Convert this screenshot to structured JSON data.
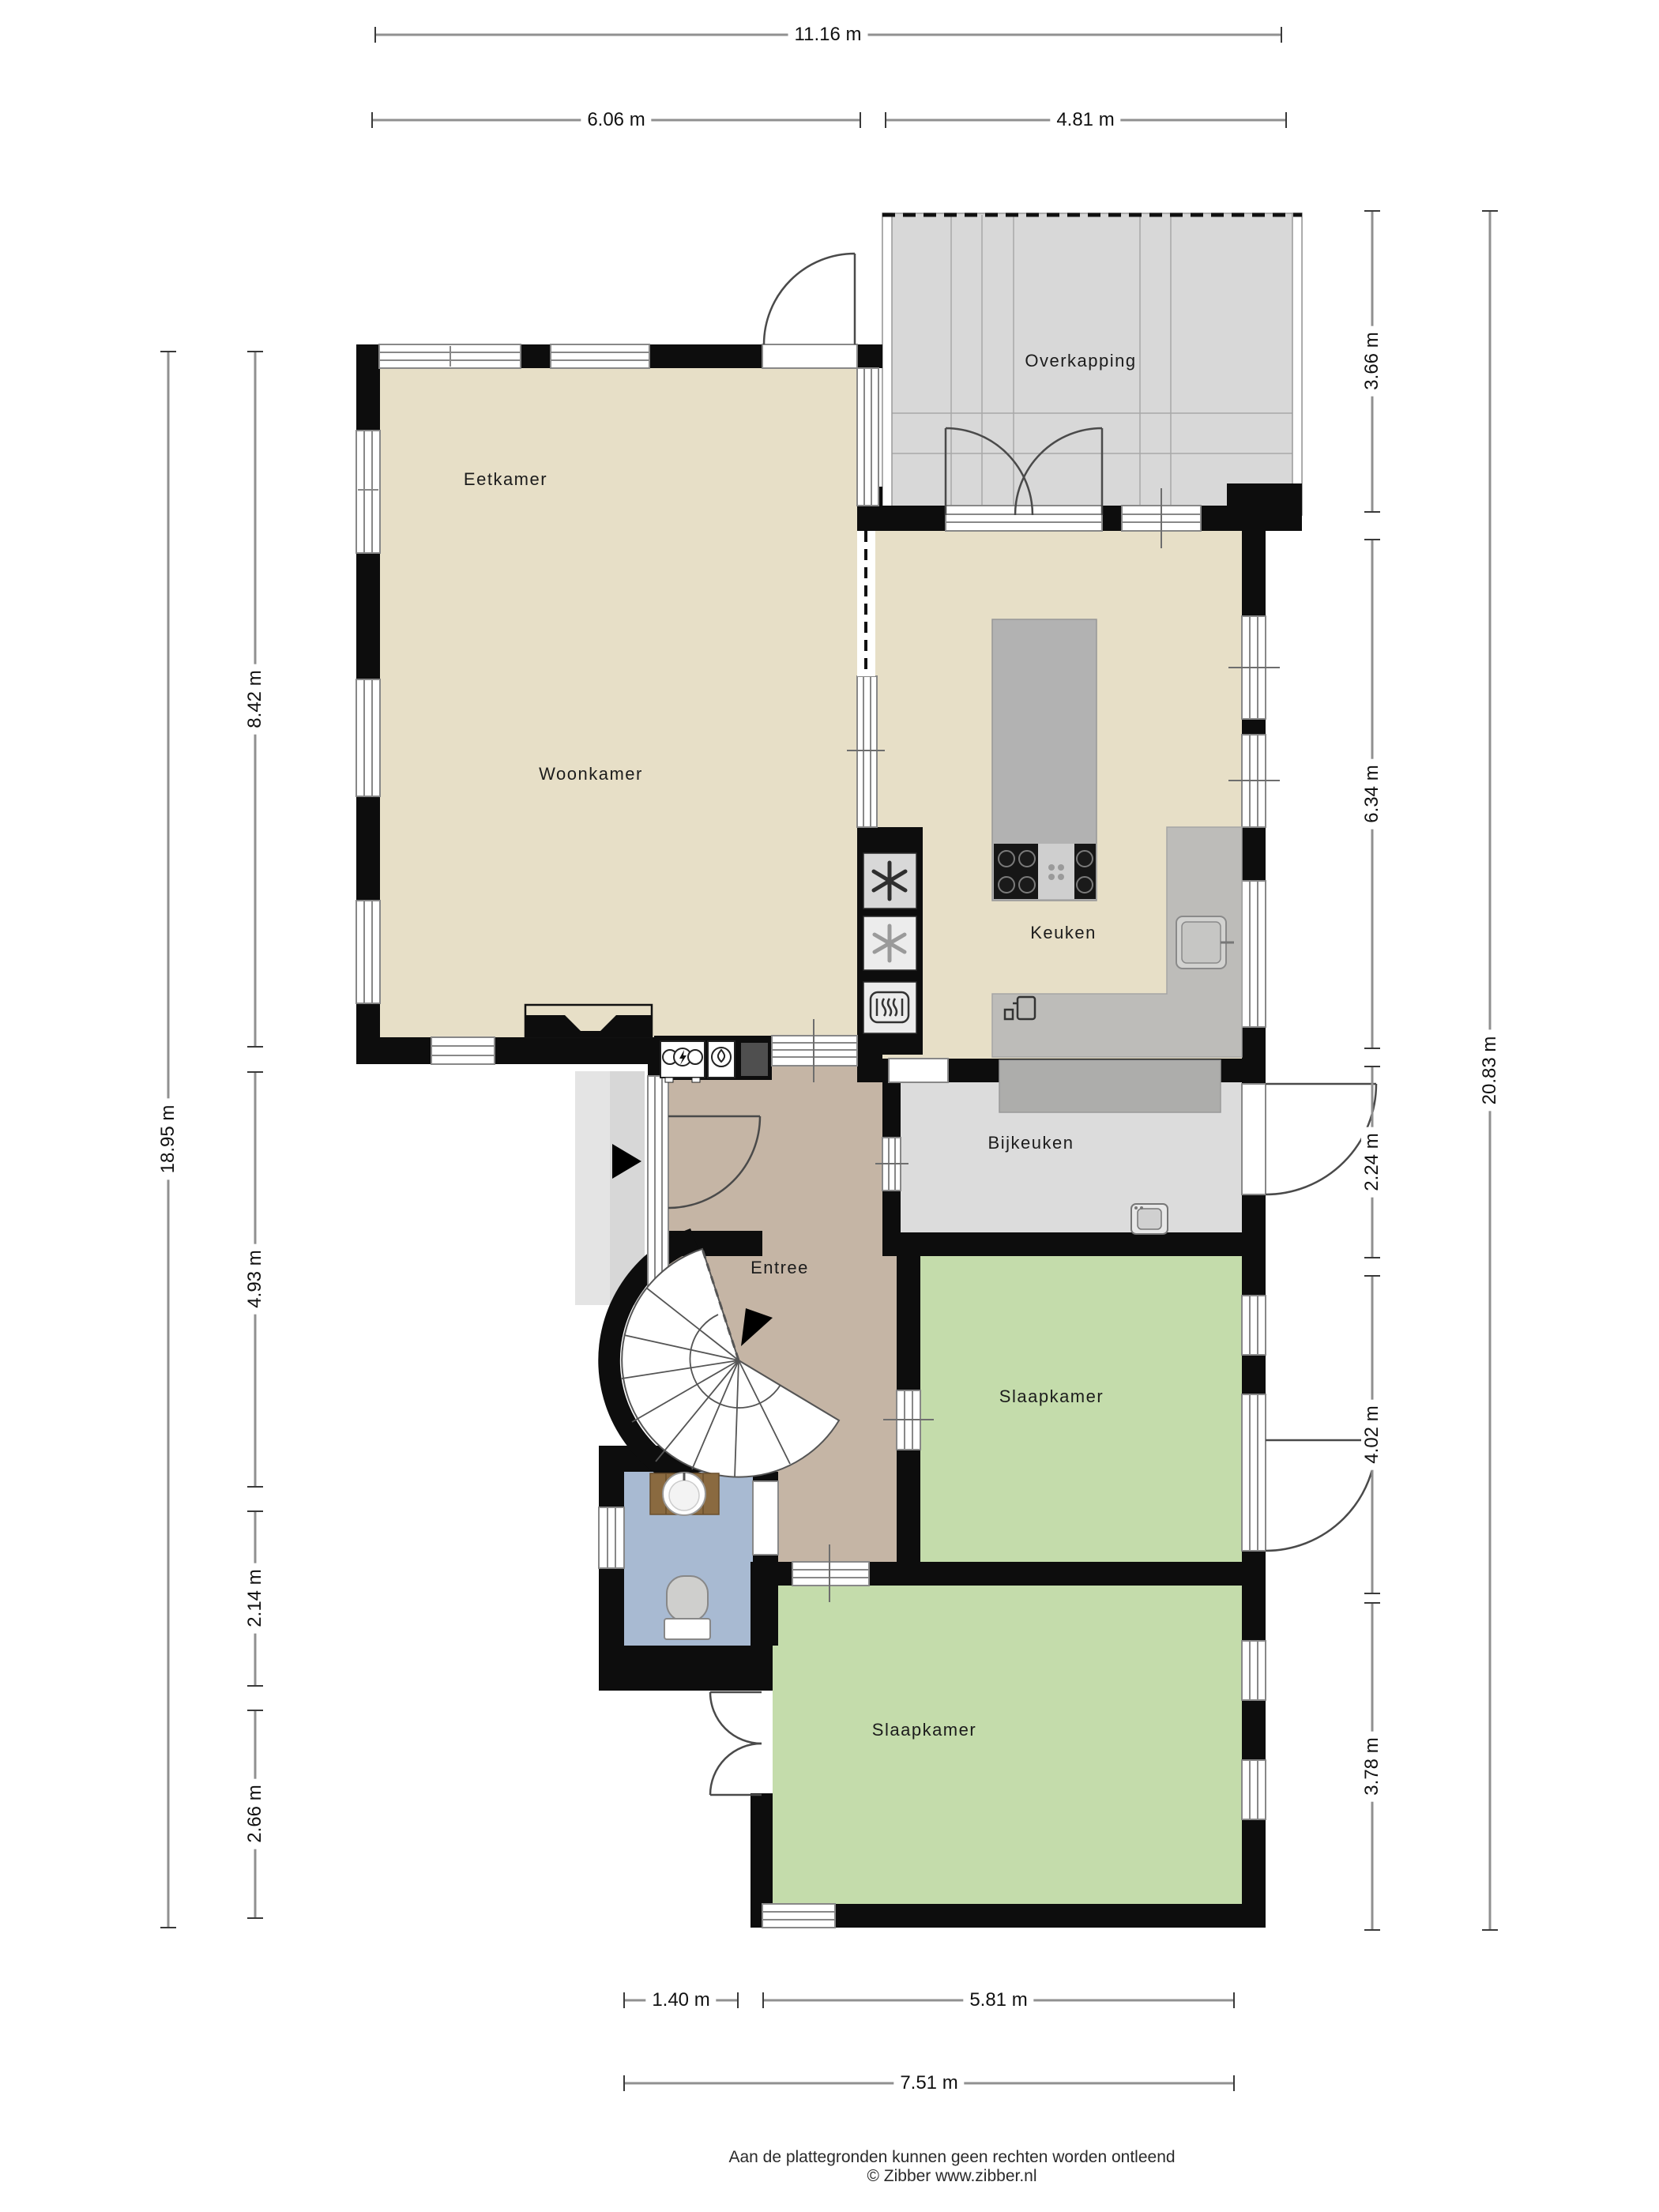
{
  "plan": {
    "rooms": [
      {
        "id": "eetkamer",
        "label": "Eetkamer"
      },
      {
        "id": "woonkamer",
        "label": "Woonkamer"
      },
      {
        "id": "keuken",
        "label": "Keuken"
      },
      {
        "id": "overkapping",
        "label": "Overkapping"
      },
      {
        "id": "bijkeuken",
        "label": "Bijkeuken"
      },
      {
        "id": "entree",
        "label": "Entree"
      },
      {
        "id": "slaapkamer_1",
        "label": "Slaapkamer"
      },
      {
        "id": "slaapkamer_2",
        "label": "Slaapkamer"
      }
    ],
    "dimensions": {
      "top_total": "11.16 m",
      "top_left": "6.06 m",
      "top_right": "4.81 m",
      "left_total": "18.95 m",
      "left_segments": [
        "8.42 m",
        "4.93 m",
        "2.14 m",
        "2.66 m"
      ],
      "right_total": "20.83 m",
      "right_segments": [
        "3.66 m",
        "6.34 m",
        "2.24 m",
        "4.02 m",
        "3.78 m"
      ],
      "bottom_left": "1.40 m",
      "bottom_right": "5.81 m",
      "bottom_total": "7.51 m"
    },
    "icons": [
      "fridge-icon",
      "freezer-icon",
      "oven-icon",
      "electricity-meter-icon",
      "gas-meter-icon",
      "cooktop-icon",
      "kitchen-sink-icon",
      "coffee-machine-icon",
      "washing-machine-icon",
      "toilet-icon",
      "washbasin-icon",
      "spiral-staircase",
      "entrance-arrow-icon"
    ],
    "colors": {
      "living": "#e7dfc7",
      "entree": "#c5b5a5",
      "bedroom": "#c4dcab",
      "bathroom": "#a8bad2",
      "utility": "#dcdcdc",
      "overkapping": "#d8d8d8",
      "island": "#b2b2b2",
      "counter": "#bdbcb9",
      "counter_dark": "#adadab",
      "vanity": "#8a6a40",
      "wall": "#0d0d0d",
      "dim_line": "#909090"
    },
    "footer": {
      "disclaimer": "Aan de plattegronden kunnen geen rechten worden ontleend",
      "copyright": "© Zibber www.zibber.nl"
    }
  }
}
